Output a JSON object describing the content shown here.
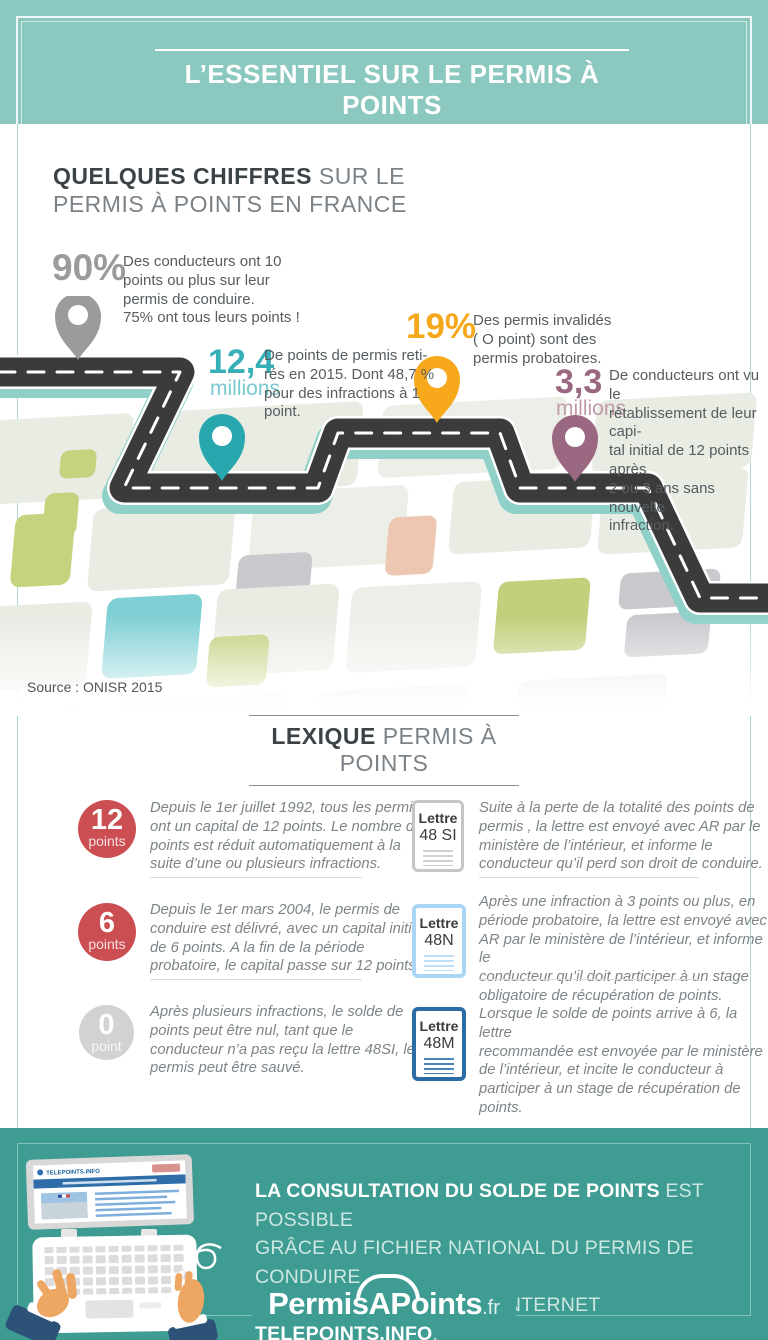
{
  "header": {
    "title": "L’ESSENTIEL SUR LE PERMIS À POINTS"
  },
  "intro": {
    "heading_bold": "QUELQUES CHIFFRES",
    "heading_light": " SUR LE",
    "heading_line2": "PERMIS À POINTS EN FRANCE"
  },
  "stats": [
    {
      "value": "90%",
      "desc": "Des conducteurs ont 10\npoints ou plus sur leur\npermis de conduire.\n75% ont tous leurs points !",
      "color": "#9b9b9b"
    },
    {
      "value": "12,4",
      "unit": "millions",
      "desc": "De points de permis reti-\nrés en 2015. Dont 48,7 %\npour des infractions à 1\npoint.",
      "color": "#36afb8"
    },
    {
      "value": "19%",
      "desc": "Des permis invalidés\n( O point) sont des\npermis probatoires.",
      "color": "#f6a81c"
    },
    {
      "value": "3,3",
      "unit": "millions",
      "desc": "De conducteurs ont vu le\nrétablissement de leur capi-\ntal initial de 12 points après\n2 ou 3 ans sans nouvelle\ninfraction.",
      "color": "#9a6880"
    }
  ],
  "map": {
    "source": "Source : ONISR 2015"
  },
  "lexique": {
    "heading_bold": "LEXIQUE",
    "heading_light": " PERMIS À POINTS",
    "left": [
      {
        "badge_value": "12",
        "badge_label": "points",
        "text": "Depuis  le 1er juillet 1992, tous les permis\nont un capital de 12 points. Le nombre de\npoints est réduit automatiquement à la\nsuite d’une ou plusieurs infractions."
      },
      {
        "badge_value": "6",
        "badge_label": "points",
        "text": "Depuis le 1er mars 2004, le permis de\nconduire est délivré, avec un capital initial\nde 6 points. A la fin de la période\nprobatoire, le capital passe sur 12 points."
      },
      {
        "badge_value": "0",
        "badge_label": "point",
        "text": "Après plusieurs infractions, le solde de\npoints peut être nul, tant que le\nconducteur n’a pas reçu la lettre 48SI, le\npermis peut être sauvé."
      }
    ],
    "right": [
      {
        "letter_word": "Lettre",
        "letter_code": "48 SI",
        "accent": "#c6c6c6",
        "text": "Suite à la perte de la totalité des points de\npermis , la lettre est envoyé avec AR par le\nministère de l’intérieur, et informe le\nconducteur qu’il perd son droit de conduire."
      },
      {
        "letter_word": "Lettre",
        "letter_code": "48N",
        "accent": "#a9d6f5",
        "text": "Après une infraction à 3 points ou plus, en\npériode probatoire, la lettre est envoyé avec\nAR par le ministère de l’intérieur, et informe le\nconducteur qu’il doit participer à un stage\nobligatoire de récupération de points."
      },
      {
        "letter_word": "Lettre",
        "letter_code": "48M",
        "accent": "#2c6ca5",
        "text": "Lorsque le solde de points arrive à 6, la lettre\nrecommandée est envoyée  par le ministère\nde l’intérieur, et incite le conducteur à\nparticiper à un stage de récupération de\npoints."
      }
    ]
  },
  "footer": {
    "line1_bold": "LA CONSULTATION DU SOLDE DE POINTS",
    "line1_light": " EST POSSIBLE",
    "line2": "GRÂCE AU FICHIER NATIONAL DU PERMIS DE CONDUIRE",
    "line3_light": "ACCESSIBLE VIA LE SITE INTERNET ",
    "line3_bold": "TELEPOINTS.INFO",
    "line3_end": ".",
    "laptop_screen_title": "TELEPOINTS.INFO",
    "logo_part1": "Permis",
    "logo_part2": "A",
    "logo_part3": "Points",
    "logo_suffix": ".fr"
  },
  "colors": {
    "header_bg": "#8bc8bf",
    "footer_bg": "#3e9c92",
    "stat_gray": "#9b9b9b",
    "stat_teal": "#36afb8",
    "stat_orange": "#f6a81c",
    "stat_mauve": "#9a6880",
    "badge_red": "#cb4e52",
    "badge_gray": "#d2d2d2",
    "letter_48si": "#c6c6c6",
    "letter_48n": "#a9d6f5",
    "letter_48m": "#2c6ca5",
    "road": "#3b3b3b",
    "road_shadow": "#8fd0c8"
  }
}
